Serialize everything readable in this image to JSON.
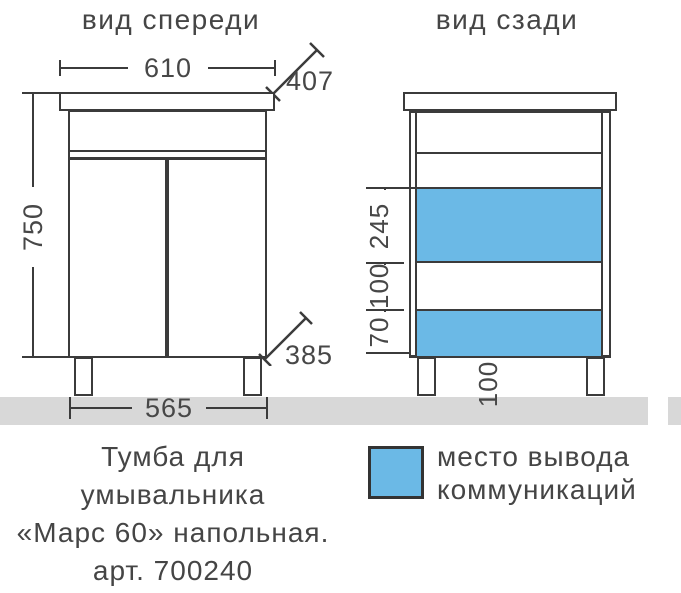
{
  "front_view": {
    "title": "вид спереди",
    "dims": {
      "top_width": "610",
      "depth": "407",
      "height": "750",
      "bottom_width": "565",
      "corner_depth": "385"
    }
  },
  "back_view": {
    "title": "вид сзади",
    "dims": {
      "zone_upper": "245",
      "zone_middle": "100",
      "zone_lower": "70",
      "leg_height": "100"
    }
  },
  "legend": {
    "label_line1": "место вывода",
    "label_line2": "коммуникаций",
    "swatch_color": "#6bb9e6"
  },
  "caption": {
    "line1": "Тумба для",
    "line2": "умывальника",
    "line3": "«Марс 60» напольная.",
    "line4": "арт. 700240"
  },
  "colors": {
    "communication_zone": "#6bb9e6",
    "floor": "#d8d8d8",
    "line": "#3b3b3b",
    "text": "#474747"
  }
}
